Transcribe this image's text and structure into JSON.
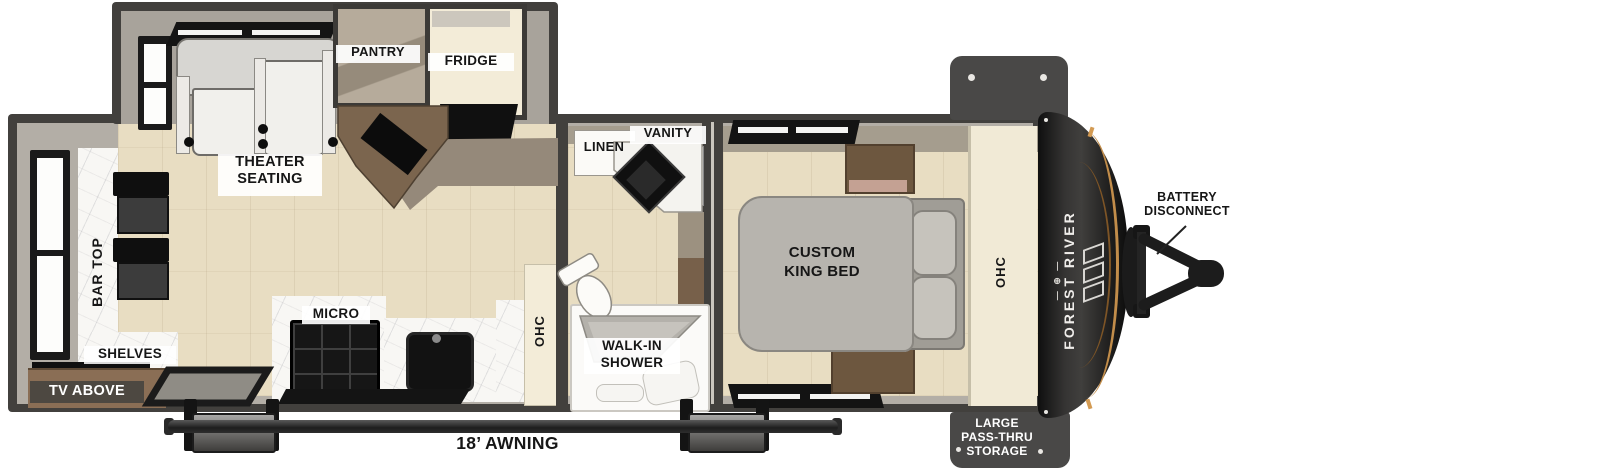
{
  "labels": {
    "pantry": "PANTRY",
    "fridge": "FRIDGE",
    "theater_seating": "THEATER\nSEATING",
    "bar_top": "BAR TOP",
    "shelves": "SHELVES",
    "tv_above": "TV ABOVE",
    "micro": "MICRO",
    "ohc_kitchen": "OHC",
    "linen": "LINEN",
    "vanity": "VANITY",
    "walk_in_shower": "WALK-IN\nSHOWER",
    "custom_king_bed": "CUSTOM\nKING BED",
    "ohc_bedroom": "OHC",
    "brand": "FOREST RIVER",
    "brand_marks": "— ⊕ —",
    "battery_disconnect": "BATTERY\nDISCONNECT",
    "pass_thru_storage": "LARGE\nPASS-THRU\nSTORAGE",
    "awning": "18’ AWNING"
  },
  "colors": {
    "wall_dark": "#42403d",
    "wall_core": "#b3aea6",
    "slide_gray": "#a8a39b",
    "floor_tan": "#e8ddc2",
    "marble_white": "#f8f7f4",
    "cream_cabinet": "#f3ecd8",
    "cabinet_brown": "#6d573f",
    "bed_gray": "#b7b4ae",
    "counter_taupe": "#95897a",
    "cap_black": "#1c1c1c",
    "accent_amber": "#c28d4a",
    "label_black": "#161616",
    "label_white": "#ffffff"
  }
}
